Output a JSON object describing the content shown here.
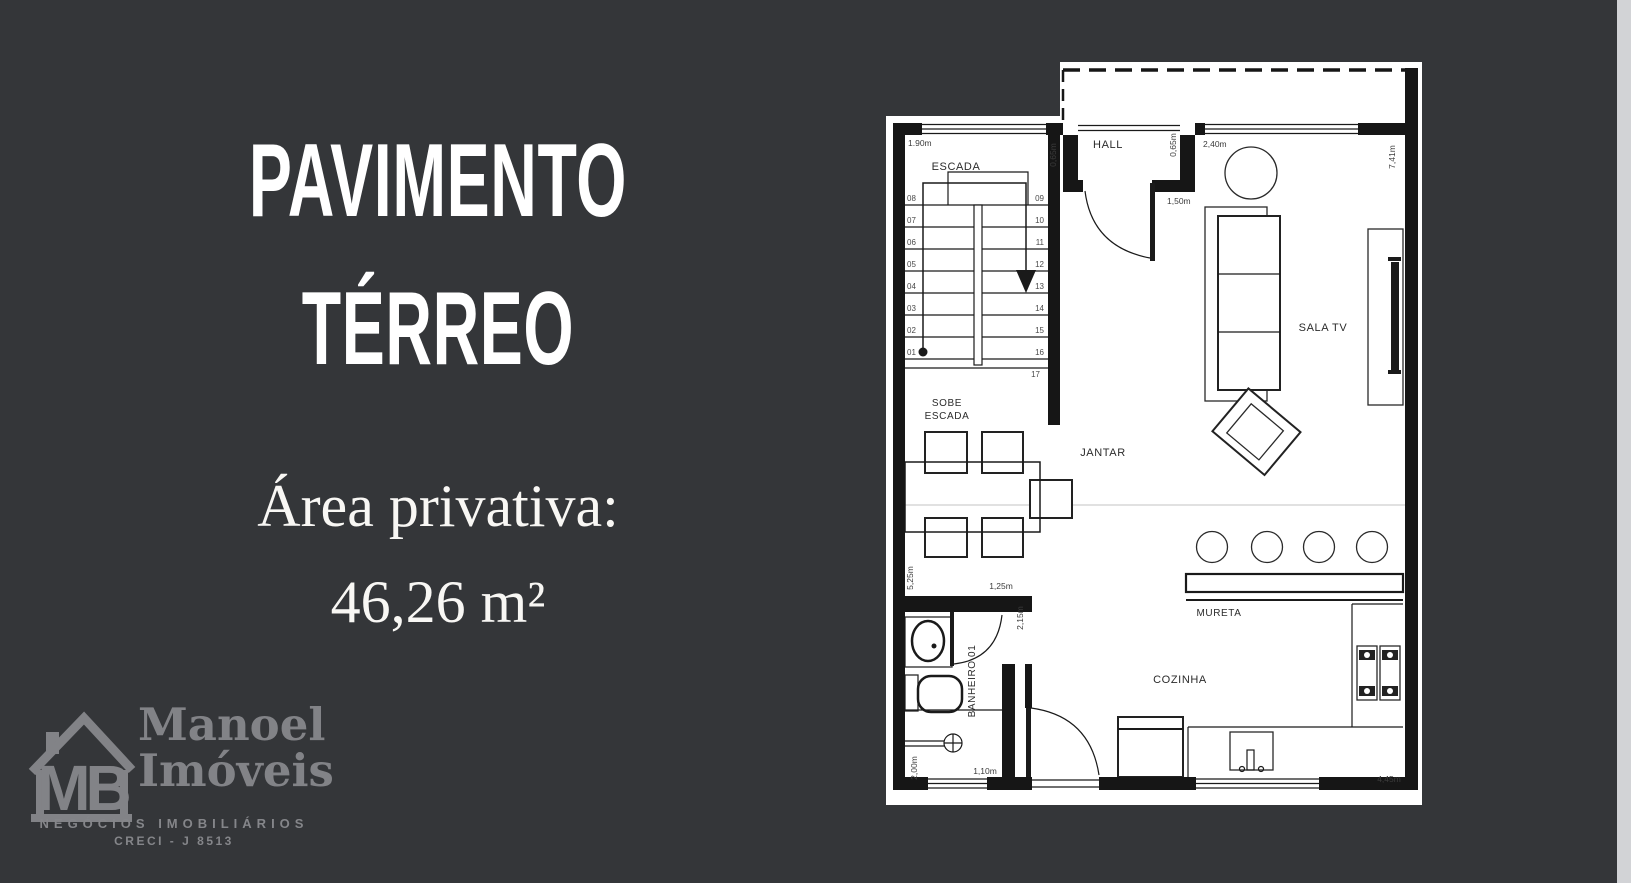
{
  "title": {
    "line1": "PAVIMENTO",
    "line2": "TÉRREO"
  },
  "area": {
    "label": "Área privativa:",
    "value": "46,26 m²"
  },
  "logo": {
    "monogram": "MB",
    "name_line1": "Manoel",
    "name_line2": "Imóveis",
    "tagline": "NEGÓCIOS IMOBILIÁRIOS",
    "creci": "CRECI - J 8513"
  },
  "plan": {
    "rooms": {
      "hall": "HALL",
      "escada": "ESCADA",
      "sobe_line1": "SOBE",
      "sobe_line2": "ESCADA",
      "sala_tv": "SALA TV",
      "jantar": "JANTAR",
      "cozinha": "COZINHA",
      "mureta": "MURETA",
      "banheiro": "BANHEIRO 01"
    },
    "dimensions": {
      "stair_width": "1.90m",
      "stair_right": "0,65m",
      "hall_right": "0,65m",
      "hall_width": "2,40m",
      "entry": "1,50m",
      "right_wall": "7,41m",
      "left_wall": "5,25m",
      "bath_top": "1,25m",
      "bath_right": "2,15m",
      "bath_left": "2,00m",
      "bath_bottom": "1,10m",
      "kitchen_bottom": "4,45m"
    },
    "stairs": {
      "left": [
        "08",
        "07",
        "06",
        "05",
        "04",
        "03",
        "02",
        "01"
      ],
      "right": [
        "09",
        "10",
        "11",
        "12",
        "13",
        "14",
        "15",
        "16",
        "17"
      ]
    }
  },
  "colors": {
    "background": "#343639",
    "panel_text": "#ffffff",
    "logo_gray": "#828387",
    "plan_paper": "#ffffff",
    "plan_line": "#1a1a1a",
    "edge_strip": "#d2d3d6"
  }
}
